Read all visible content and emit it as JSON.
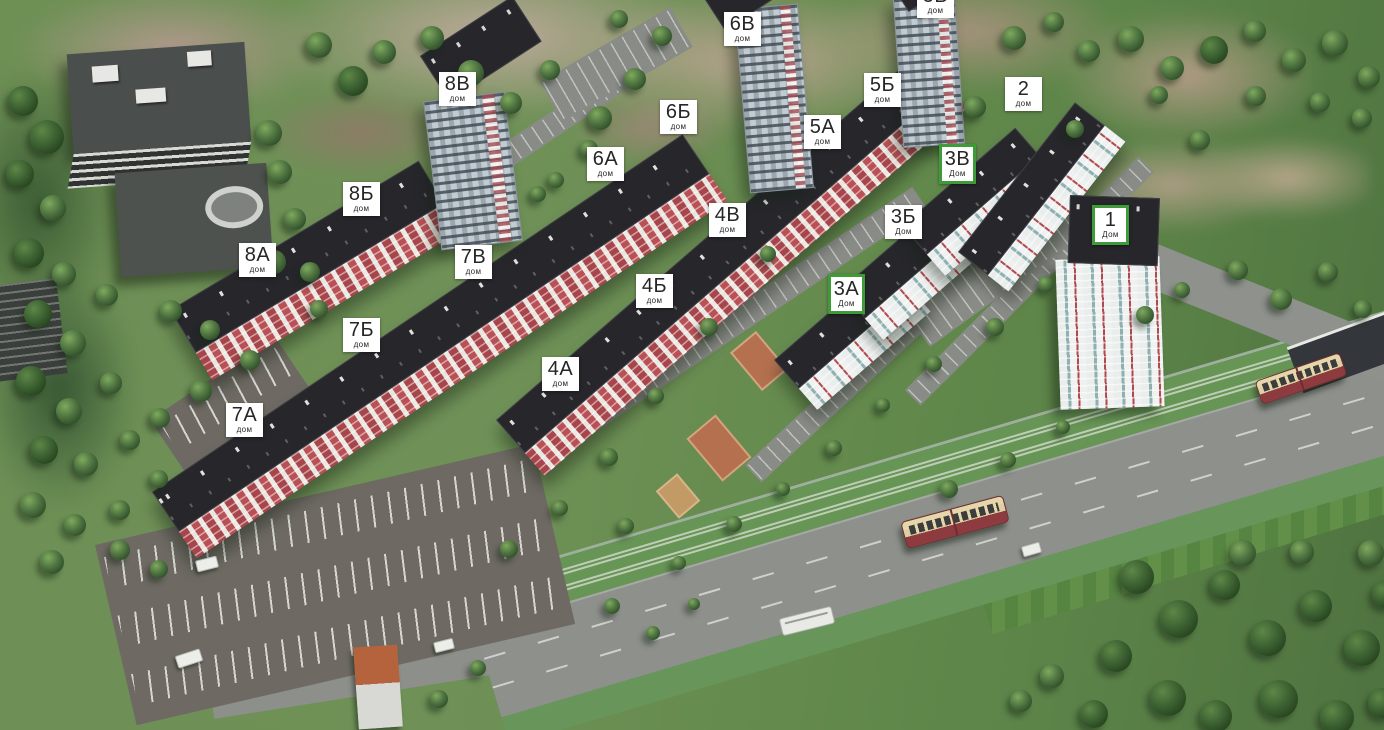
{
  "scene": {
    "description": "3D aerial masterplan of residential complex with labeled buildings"
  },
  "colors": {
    "label_bg": "#ffffff",
    "label_fg": "#262626",
    "active_green": "#3f9b3a",
    "facade_red": "#a8454b",
    "roof_dark": "#26262b",
    "grass": "#6f9157",
    "road": "#8e908c",
    "tram_cream": "#e6d7ab",
    "tram_maroon": "#8e3b40"
  },
  "buildings": [
    {
      "id": "5v",
      "label": "5В",
      "sublabel": "дом",
      "x": 917,
      "y": -16,
      "highlighted": false
    },
    {
      "id": "6v",
      "label": "6В",
      "sublabel": "дом",
      "x": 724,
      "y": 12,
      "highlighted": false
    },
    {
      "id": "8v",
      "label": "8В",
      "sublabel": "дом",
      "x": 439,
      "y": 72,
      "highlighted": false
    },
    {
      "id": "5b",
      "label": "5Б",
      "sublabel": "дом",
      "x": 864,
      "y": 73,
      "highlighted": false
    },
    {
      "id": "2",
      "label": "2",
      "sublabel": "дом",
      "x": 1005,
      "y": 77,
      "highlighted": false
    },
    {
      "id": "6b",
      "label": "6Б",
      "sublabel": "дом",
      "x": 660,
      "y": 100,
      "highlighted": false
    },
    {
      "id": "5a",
      "label": "5А",
      "sublabel": "дом",
      "x": 804,
      "y": 115,
      "highlighted": false
    },
    {
      "id": "3v",
      "label": "3В",
      "sublabel": "Дом",
      "x": 939,
      "y": 144,
      "highlighted": true
    },
    {
      "id": "6a",
      "label": "6А",
      "sublabel": "дом",
      "x": 587,
      "y": 147,
      "highlighted": false
    },
    {
      "id": "8b",
      "label": "8Б",
      "sublabel": "дом",
      "x": 343,
      "y": 182,
      "highlighted": false
    },
    {
      "id": "4v",
      "label": "4В",
      "sublabel": "дом",
      "x": 709,
      "y": 203,
      "highlighted": false
    },
    {
      "id": "3b",
      "label": "3Б",
      "sublabel": "Дом",
      "x": 885,
      "y": 205,
      "highlighted": false
    },
    {
      "id": "1",
      "label": "1",
      "sublabel": "Дом",
      "x": 1092,
      "y": 205,
      "highlighted": true
    },
    {
      "id": "8a",
      "label": "8А",
      "sublabel": "дом",
      "x": 239,
      "y": 243,
      "highlighted": false
    },
    {
      "id": "7v",
      "label": "7В",
      "sublabel": "дом",
      "x": 455,
      "y": 245,
      "highlighted": false
    },
    {
      "id": "4b",
      "label": "4Б",
      "sublabel": "дом",
      "x": 636,
      "y": 274,
      "highlighted": false
    },
    {
      "id": "3a",
      "label": "3А",
      "sublabel": "Дом",
      "x": 828,
      "y": 274,
      "highlighted": true
    },
    {
      "id": "7b",
      "label": "7Б",
      "sublabel": "дом",
      "x": 343,
      "y": 318,
      "highlighted": false
    },
    {
      "id": "4a",
      "label": "4А",
      "sublabel": "дом",
      "x": 542,
      "y": 357,
      "highlighted": false
    },
    {
      "id": "7a",
      "label": "7А",
      "sublabel": "дом",
      "x": 226,
      "y": 403,
      "highlighted": false
    }
  ]
}
